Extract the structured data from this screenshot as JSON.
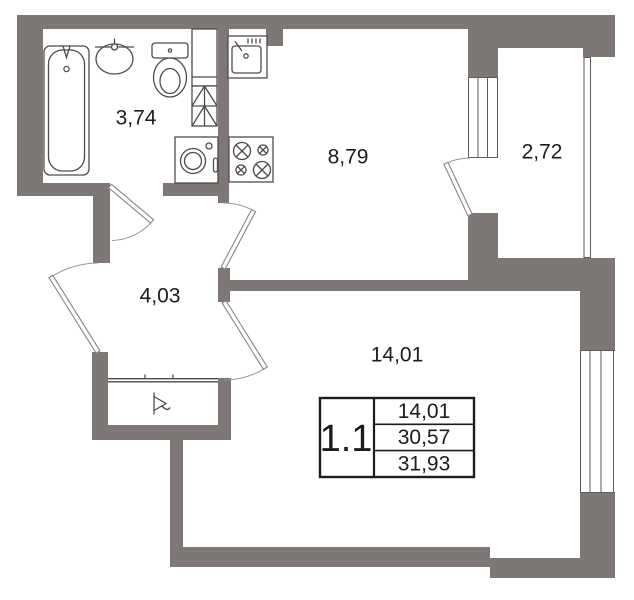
{
  "plan": {
    "rooms": [
      {
        "id": "bathroom",
        "area": "3,74"
      },
      {
        "id": "kitchen",
        "area": "8,79"
      },
      {
        "id": "balcony",
        "area": "2,72"
      },
      {
        "id": "hallway",
        "area": "4,03"
      },
      {
        "id": "living-room",
        "area": "14,01"
      }
    ],
    "info_table": {
      "unit_number": "1.1",
      "rows": [
        {
          "value": "14,01"
        },
        {
          "value": "30,57"
        },
        {
          "value": "31,93"
        }
      ]
    },
    "fixtures": [
      "bathtub",
      "washbasin",
      "toilet",
      "washing-machine",
      "vent-shaft",
      "cupboard",
      "kitchen-sink",
      "stove",
      "wardrobe",
      "entrance-arrow"
    ],
    "colors": {
      "wall": "#7d7775",
      "fixture_line": "#4f4b4a",
      "door_line": "#8a8482",
      "text": "#1c1c1c",
      "background": "#ffffff"
    }
  }
}
